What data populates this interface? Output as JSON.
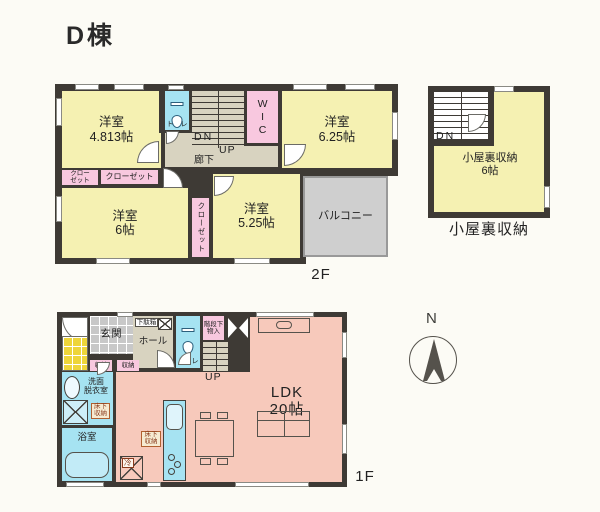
{
  "title": "D棟",
  "colors": {
    "wall": "#3e3a35",
    "room_yellow": "#f5f1b2",
    "closet_pink": "#f8c8df",
    "water_blue": "#a6e3f2",
    "ldk_pink": "#f7c9bb",
    "corridor_beige": "#d8d3c0",
    "tile_gray": "#c8c8c8",
    "porch_yellow": "#eed53a",
    "balcony_gray": "#cfcfcf",
    "background": "#fcfbf5"
  },
  "f2": {
    "floor_label": "2F",
    "room_yoshitsu_4813": "洋室\n4.813帖",
    "toilet": "トイレ",
    "stairs_dn": "DN",
    "stairs_up": "UP",
    "hallway": "廊下",
    "wic": "WIC",
    "room_yoshitsu_625": "洋室\n6.25帖",
    "closet_small": "クロー\nゼット",
    "closet_wide": "クローゼット",
    "room_yoshitsu_6": "洋室\n6帖",
    "closet_vertical": "クローゼット",
    "room_yoshitsu_525": "洋室\n5.25帖",
    "balcony": "バルコニー"
  },
  "attic": {
    "stairs_dn": "DN",
    "room": "小屋裏収納\n6帖",
    "caption": "小屋裏収納"
  },
  "f1": {
    "floor_label": "1F",
    "genkan": "玄関",
    "getabako": "下駄箱",
    "hall": "ホール",
    "toilet": "トイレ",
    "under_stairs_storage": "階段下\n物入",
    "stairs_up": "UP",
    "storage_a": "収納",
    "storage_b": "収納",
    "washroom": "洗面\n脱衣室",
    "underfloor_a": "床下\n収納",
    "underfloor_b": "床下\n収納",
    "bathroom": "浴室",
    "fridge": "冷",
    "ldk": "LDK\n20帖"
  },
  "compass": {
    "north_label": "N"
  }
}
